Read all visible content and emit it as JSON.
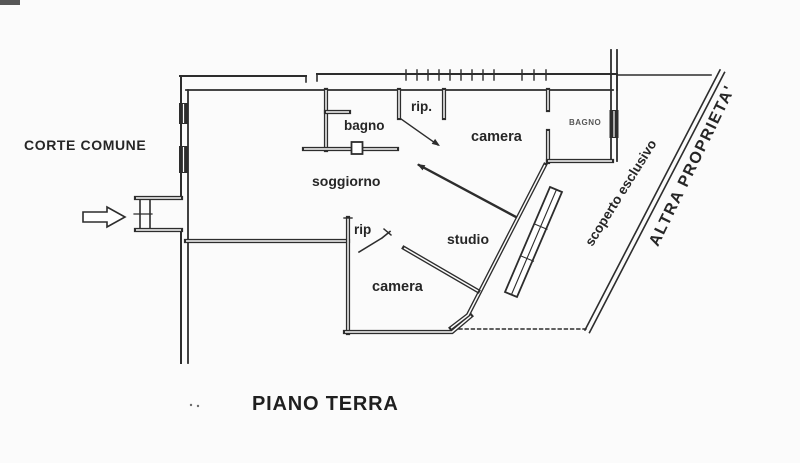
{
  "plan": {
    "title": "PIANO TERRA",
    "outside_label": "CORTE COMUNE",
    "rooms": {
      "bagno_top": "bagno",
      "rip_top": "rip.",
      "camera_top": "camera",
      "bagno_right": "BAGNO",
      "soggiorno": "soggiorno",
      "rip_bottom": "rip",
      "studio": "studio",
      "camera_bottom": "camera"
    },
    "annotations": {
      "scoperto": "scoperto esclusivo",
      "altra_proprieta": "ALTRA PROPRIETA'"
    },
    "icons": {
      "entrance_arrow": "entrance-arrow-icon"
    }
  },
  "colors": {
    "ink": "#2d2d2d",
    "paper": "#fbfbfb"
  }
}
